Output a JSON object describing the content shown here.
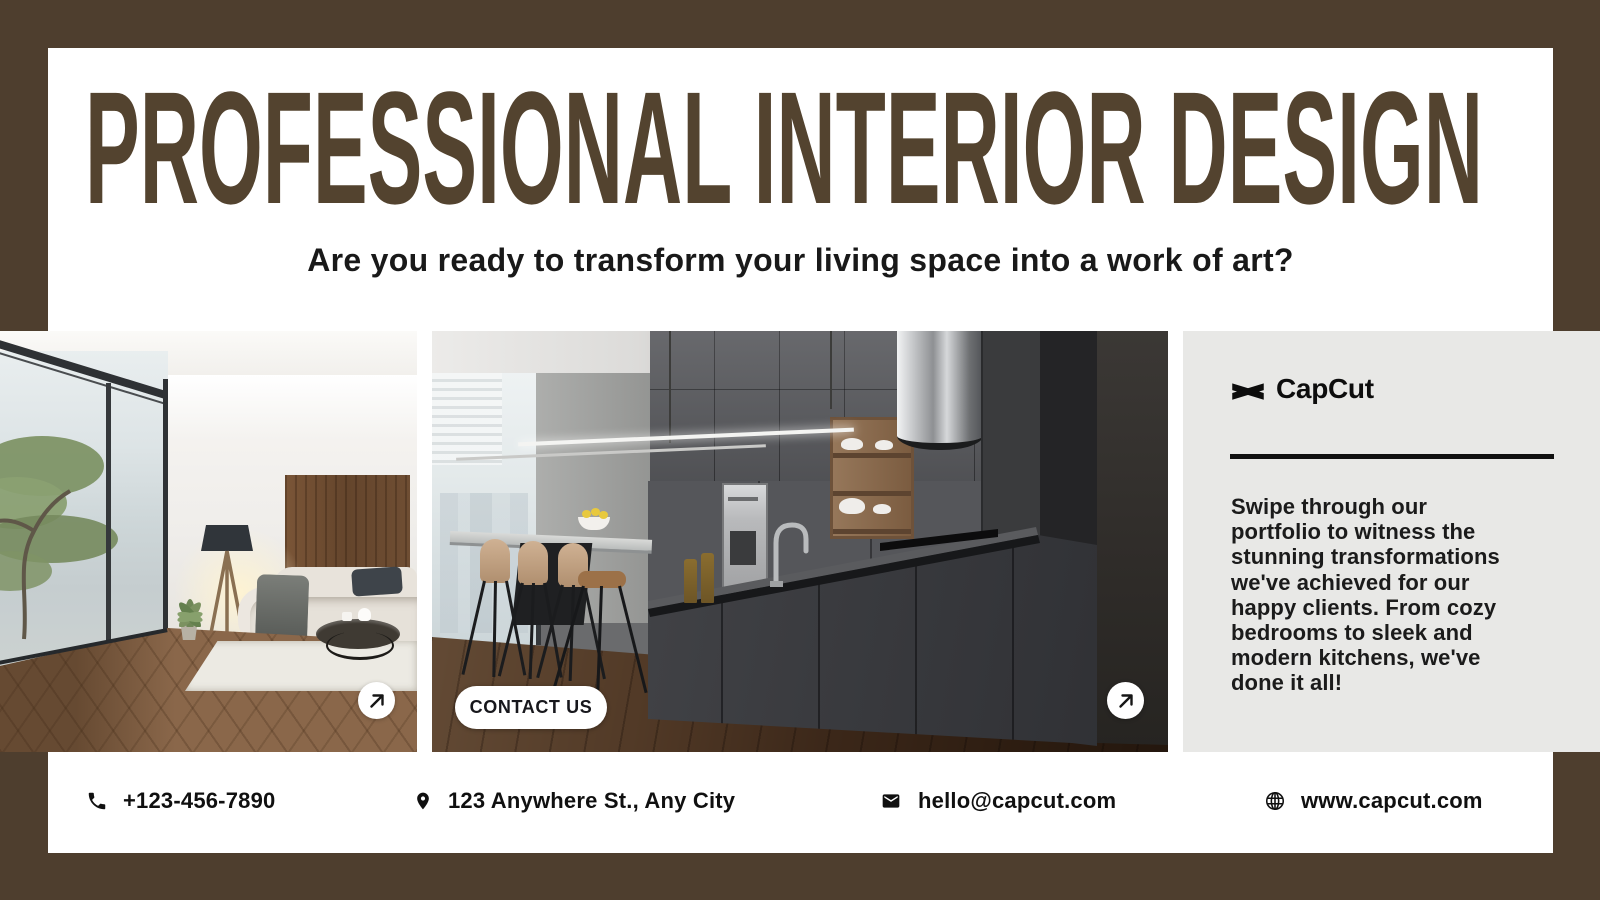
{
  "colors": {
    "frame": "#4E3E2E",
    "headline": "#53432F",
    "panel_bg": "#E8E8E6"
  },
  "header": {
    "title": "PROFESSIONAL INTERIOR DESIGN",
    "subtitle": "Are you ready to transform your living space into a work of art?"
  },
  "gallery": {
    "contact_button_label": "CONTACT US",
    "arrow_icon_name": "arrow-up-right"
  },
  "brand": {
    "name": "CapCut",
    "logo_icon_name": "capcut-logo"
  },
  "portfolio": {
    "description": "Swipe through our\nportfolio to witness the\nstunning transformations\nwe've achieved for our\nhappy clients. From cozy\nbedrooms to sleek and\nmodern kitchens, we've\ndone it all!"
  },
  "footer": {
    "phone": "+123-456-7890",
    "address": "123 Anywhere St., Any City",
    "email": "hello@capcut.com",
    "website": "www.capcut.com",
    "icons": [
      "phone",
      "map-pin",
      "envelope",
      "globe"
    ]
  }
}
